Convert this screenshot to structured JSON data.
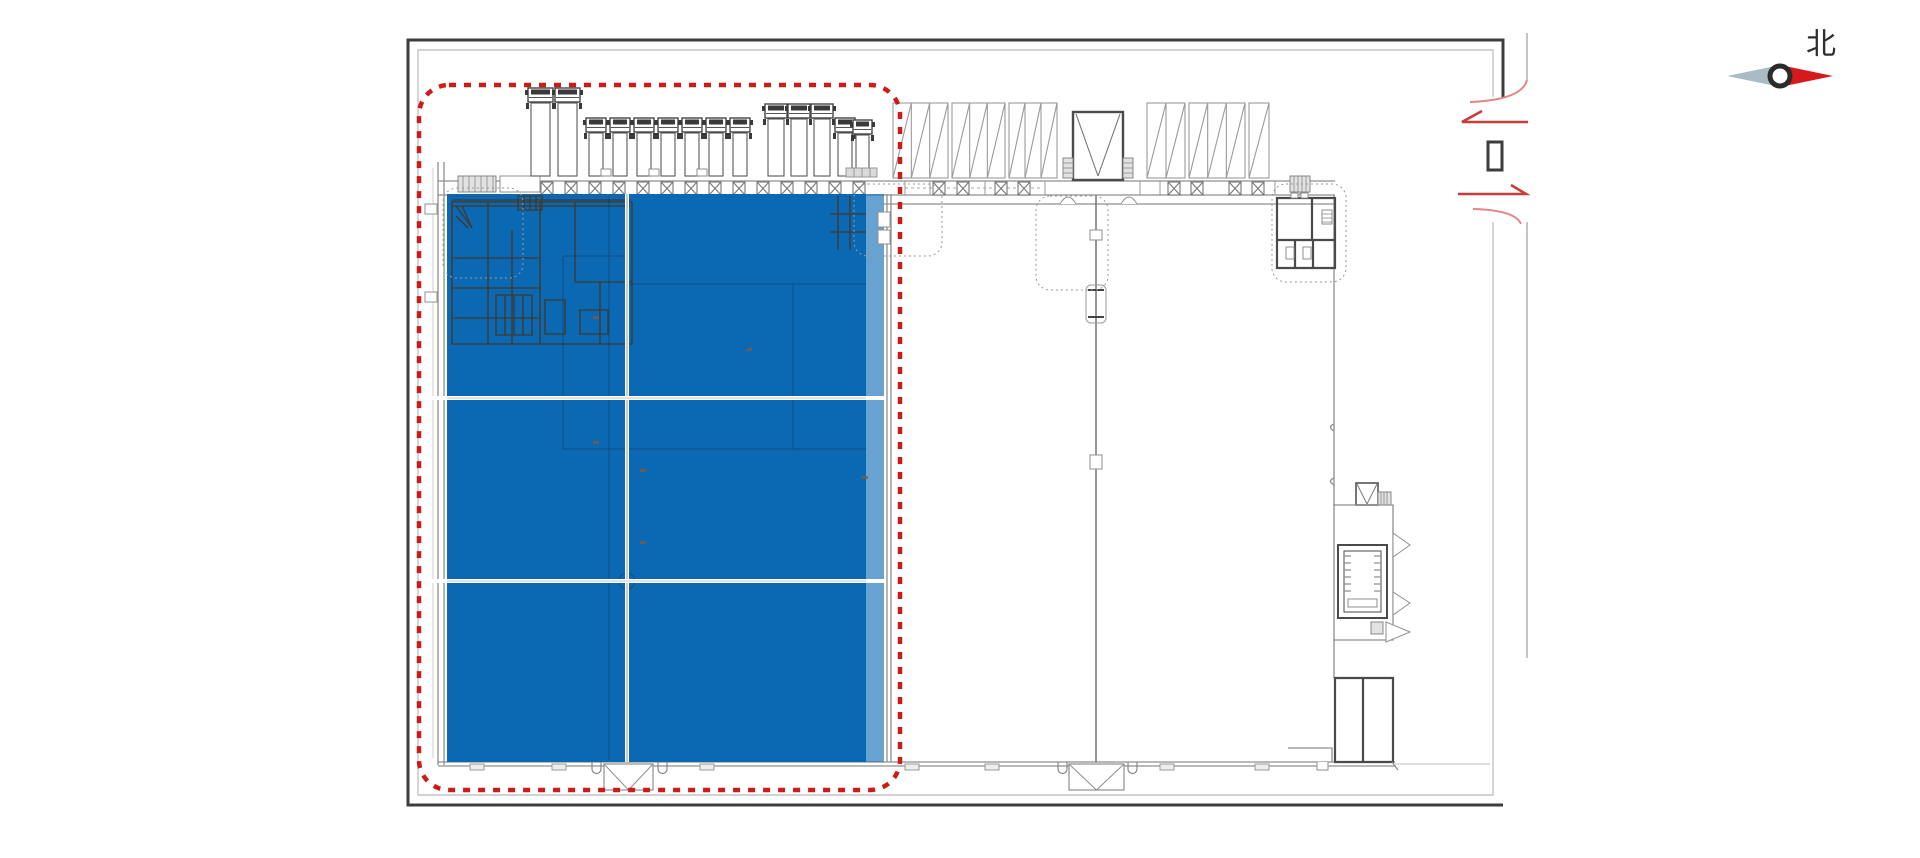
{
  "page": {
    "width": 1920,
    "height": 858,
    "background": "#ffffff"
  },
  "compass": {
    "label": "北",
    "red": "#d7191c",
    "gray": "#a9bcc6",
    "ring": "#2b2b2b"
  },
  "colors": {
    "frame_dark": "#3d3d3d",
    "frame_gray": "#c4c4c4",
    "wall": "#8f8f8f",
    "wall_dark": "#4a4a4a",
    "blue": "#0b69b4",
    "blue_light": "rgba(11,105,180,0.62)",
    "red_dash": "#cf1a1a",
    "red_arrow": "#c63d3a",
    "red_arc": "#e28783"
  },
  "highlight_zone": {
    "x": 447,
    "y": 194,
    "w": 419,
    "h": 568,
    "strip_w": 18,
    "v_lines": [
      627
    ],
    "h_lines": [
      398,
      581
    ]
  },
  "red_boundary": {
    "x": 419,
    "y": 85,
    "w": 481,
    "h": 705,
    "radius": 30,
    "dash": "7 8",
    "width": 4.5
  },
  "columns": {
    "y": 182,
    "w": 12,
    "h": 13,
    "xs": [
      541,
      565,
      589,
      613,
      637,
      661,
      685,
      709,
      733,
      757,
      781,
      805,
      829,
      853,
      933,
      957,
      995,
      1018,
      1168,
      1191,
      1229,
      1252
    ]
  },
  "trucks": [
    {
      "x": 531,
      "w": 19,
      "top": 88
    },
    {
      "x": 558,
      "w": 19,
      "top": 88
    },
    {
      "x": 589,
      "w": 14,
      "top": 118
    },
    {
      "x": 613,
      "w": 14,
      "top": 118
    },
    {
      "x": 637,
      "w": 14,
      "top": 118
    },
    {
      "x": 661,
      "w": 14,
      "top": 118
    },
    {
      "x": 685,
      "w": 14,
      "top": 118
    },
    {
      "x": 709,
      "w": 14,
      "top": 118
    },
    {
      "x": 733,
      "w": 14,
      "top": 118
    },
    {
      "x": 768,
      "w": 16,
      "top": 104
    },
    {
      "x": 791,
      "w": 16,
      "top": 104
    },
    {
      "x": 814,
      "w": 16,
      "top": 104
    },
    {
      "x": 838,
      "w": 14,
      "top": 118
    },
    {
      "x": 856,
      "w": 13,
      "top": 120
    }
  ],
  "truck_bottom": 176,
  "panels": {
    "y": 103,
    "h": 75,
    "groups": [
      {
        "x": 893,
        "w": 55,
        "cells": 3
      },
      {
        "x": 952,
        "w": 53,
        "cells": 3
      },
      {
        "x": 1009,
        "w": 48,
        "cells": 3
      },
      {
        "x": 1147,
        "w": 38,
        "cells": 2
      },
      {
        "x": 1189,
        "w": 56,
        "cells": 3
      },
      {
        "x": 1249,
        "w": 20,
        "cells": 1
      }
    ]
  },
  "enclosures": [
    {
      "x": 443,
      "y": 188,
      "w": 80,
      "h": 90
    },
    {
      "x": 854,
      "y": 184,
      "w": 88,
      "h": 72
    },
    {
      "x": 1036,
      "y": 196,
      "w": 72,
      "h": 94
    },
    {
      "x": 1272,
      "y": 184,
      "w": 74,
      "h": 98
    }
  ],
  "canopies": [
    {
      "x": 604,
      "y": 764,
      "w": 49,
      "h": 26
    },
    {
      "x": 1069,
      "y": 764,
      "w": 55,
      "h": 26
    }
  ],
  "hooks": [
    592,
    658,
    1058,
    1128
  ],
  "wall_ticks": [
    905,
    930,
    985,
    1045,
    1140,
    1160,
    1275,
    1300
  ],
  "bottom_ticks": [
    470,
    552,
    700,
    905,
    985,
    1160,
    1255
  ],
  "faint_ticks": [
    [
      593,
      316
    ],
    [
      746,
      348
    ],
    [
      593,
      441
    ],
    [
      640,
      469
    ],
    [
      862,
      476
    ],
    [
      640,
      541
    ]
  ]
}
